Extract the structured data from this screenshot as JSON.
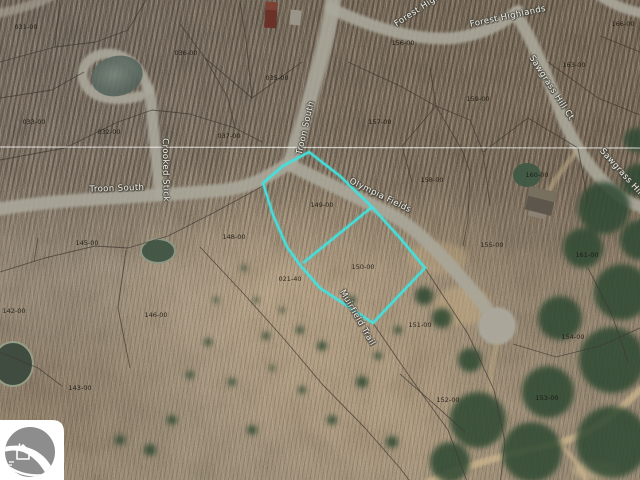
{
  "map": {
    "description": "Aerial parcel map of a wooded golf-community subdivision with two lots outlined for sale",
    "highlight_color": "#41E3E0",
    "parcel_line_color": "#3E3831",
    "section_line_color": "#FFFFFF",
    "highlighted_lots": [
      "149-00",
      "150-00"
    ],
    "parcel_labels": [
      {
        "text": "031-00",
        "x": 26,
        "y": 27
      },
      {
        "text": "036-00",
        "x": 186,
        "y": 53
      },
      {
        "text": "035-00",
        "x": 277,
        "y": 78
      },
      {
        "text": "156-00",
        "x": 403,
        "y": 43
      },
      {
        "text": "166-00",
        "x": 623,
        "y": 24
      },
      {
        "text": "163-00",
        "x": 574,
        "y": 65
      },
      {
        "text": "159-00",
        "x": 478,
        "y": 99
      },
      {
        "text": "033-00",
        "x": 34,
        "y": 122
      },
      {
        "text": "032-00",
        "x": 109,
        "y": 132
      },
      {
        "text": "037-00",
        "x": 229,
        "y": 136
      },
      {
        "text": "157-00",
        "x": 380,
        "y": 122
      },
      {
        "text": "158-00",
        "x": 432,
        "y": 180
      },
      {
        "text": "160-00",
        "x": 537,
        "y": 175
      },
      {
        "text": "149-00",
        "x": 322,
        "y": 205
      },
      {
        "text": "148-00",
        "x": 234,
        "y": 237
      },
      {
        "text": "155-00",
        "x": 492,
        "y": 245
      },
      {
        "text": "161-00",
        "x": 587,
        "y": 255
      },
      {
        "text": "150-00",
        "x": 363,
        "y": 267
      },
      {
        "text": "021-40",
        "x": 290,
        "y": 279
      },
      {
        "text": "151-00",
        "x": 420,
        "y": 325
      },
      {
        "text": "154-00",
        "x": 573,
        "y": 337
      },
      {
        "text": "145-00",
        "x": 87,
        "y": 243
      },
      {
        "text": "142-00",
        "x": 14,
        "y": 311
      },
      {
        "text": "146-00",
        "x": 156,
        "y": 315
      },
      {
        "text": "143-00",
        "x": 80,
        "y": 388
      },
      {
        "text": "153-00",
        "x": 547,
        "y": 398
      },
      {
        "text": "152-00",
        "x": 448,
        "y": 400
      }
    ],
    "road_labels": [
      {
        "text": "Troon South",
        "x": 117,
        "y": 189,
        "rot": -2
      },
      {
        "text": "Crooked Stick",
        "x": 165,
        "y": 170,
        "rot": 89
      },
      {
        "text": "Troon South",
        "x": 306,
        "y": 128,
        "rot": -77
      },
      {
        "text": "Olympia Fields",
        "x": 380,
        "y": 196,
        "rot": 26
      },
      {
        "text": "Forest Highlands",
        "x": 508,
        "y": 17,
        "rot": -12
      },
      {
        "text": "Forest Highlands",
        "x": 428,
        "y": 4,
        "rot": -33
      },
      {
        "text": "Sawgrass Hill Ct",
        "x": 551,
        "y": 88,
        "rot": 57
      },
      {
        "text": "Sawgrass Hill Ct",
        "x": 626,
        "y": 178,
        "rot": 48
      },
      {
        "text": "Muirfield Trail",
        "x": 357,
        "y": 318,
        "rot": 60
      }
    ],
    "watermark": {
      "icon": "house-on-hill-circle-logo"
    }
  }
}
